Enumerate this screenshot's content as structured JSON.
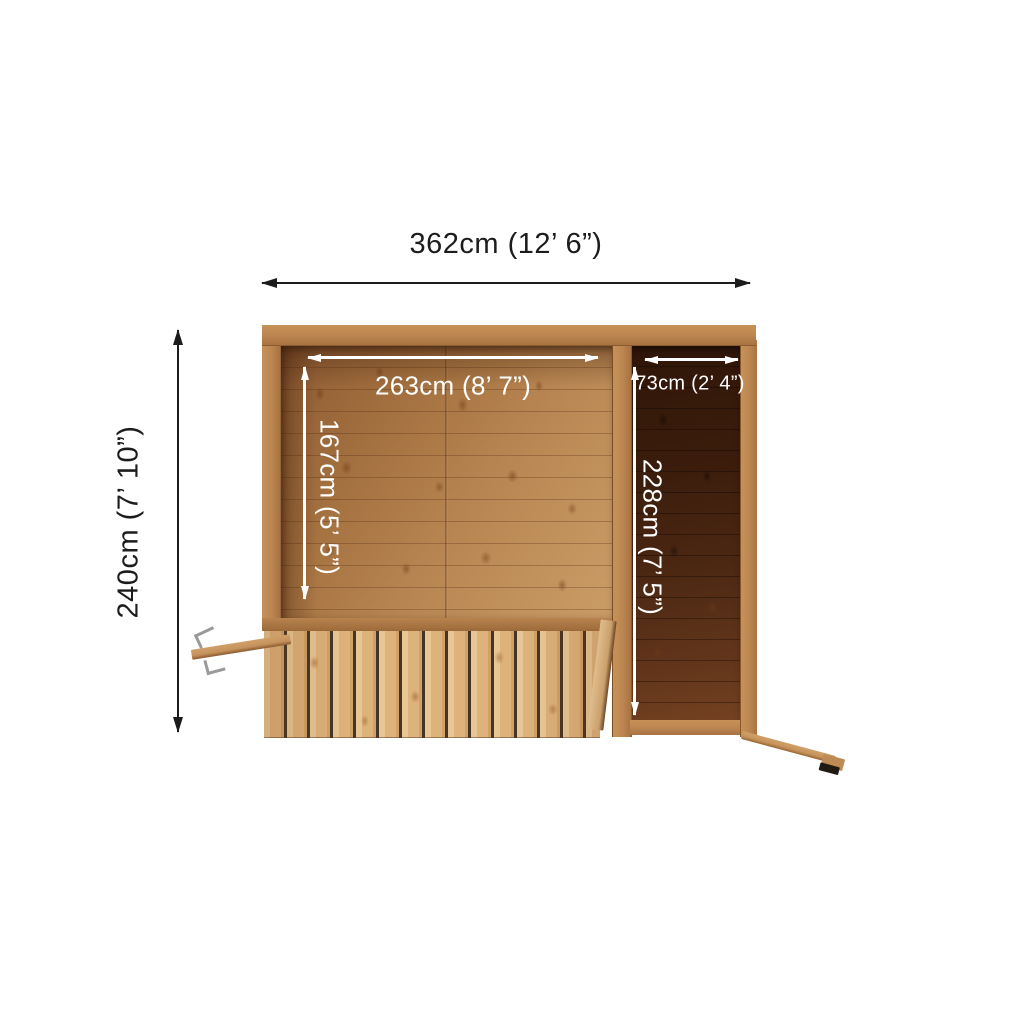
{
  "diagram": {
    "dimensions": {
      "overall_width": {
        "label": "362cm (12’ 6”)"
      },
      "overall_depth": {
        "label": "240cm (7’ 10”)"
      },
      "main_room_width": {
        "label": "263cm (8’ 7”)"
      },
      "main_room_depth": {
        "label": "167cm (5’ 5”)"
      },
      "side_room_width": {
        "label": "73cm (2’ 4”)"
      },
      "side_room_depth": {
        "label": "228cm (7’ 5”)"
      }
    },
    "colors": {
      "annotation-dark": "#1c1c1c",
      "annotation-light": "#ffffff",
      "wall-wood": "#bb8551",
      "floor-light-wood": "#b5834f",
      "floor-dark-wood": "#4c2813",
      "slat-wood": "#ddb27b",
      "metal-bracket": "#9a9a9a",
      "background": "#ffffff"
    }
  }
}
